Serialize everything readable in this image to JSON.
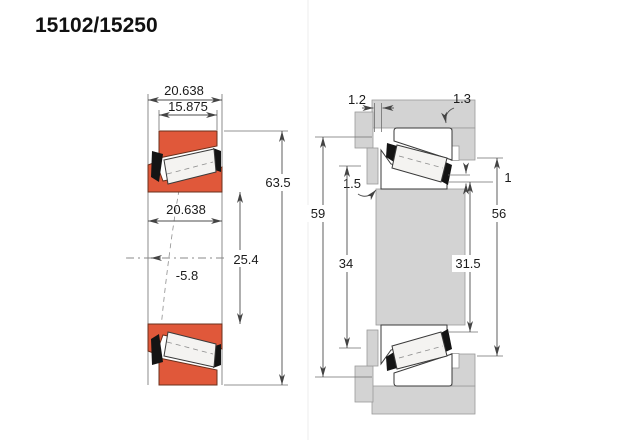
{
  "title": "15102/15250",
  "colors": {
    "ring_orange": "#e0583a",
    "metal_gray": "#d3d3d3",
    "line_dark": "#3a3a3a"
  },
  "left_view": {
    "dim_overall_width": "20.638",
    "dim_cup_width": "15.875",
    "dim_outer_diameter": "63.5",
    "dim_cone_width": "20.638",
    "dim_bore": "25.4",
    "dim_load_center": "-5.8"
  },
  "right_view": {
    "dim_backface_gap": "1.2",
    "dim_housing_fillet": "1.3",
    "dim_shaft_fillet": "1.5",
    "dim_housing_clearance_dia": "59",
    "dim_shaft_backing_dia": "34",
    "dim_front_gap": "1",
    "dim_housing_shoulder_dia": "56",
    "dim_shaft_clearance_dia": "31.5"
  }
}
